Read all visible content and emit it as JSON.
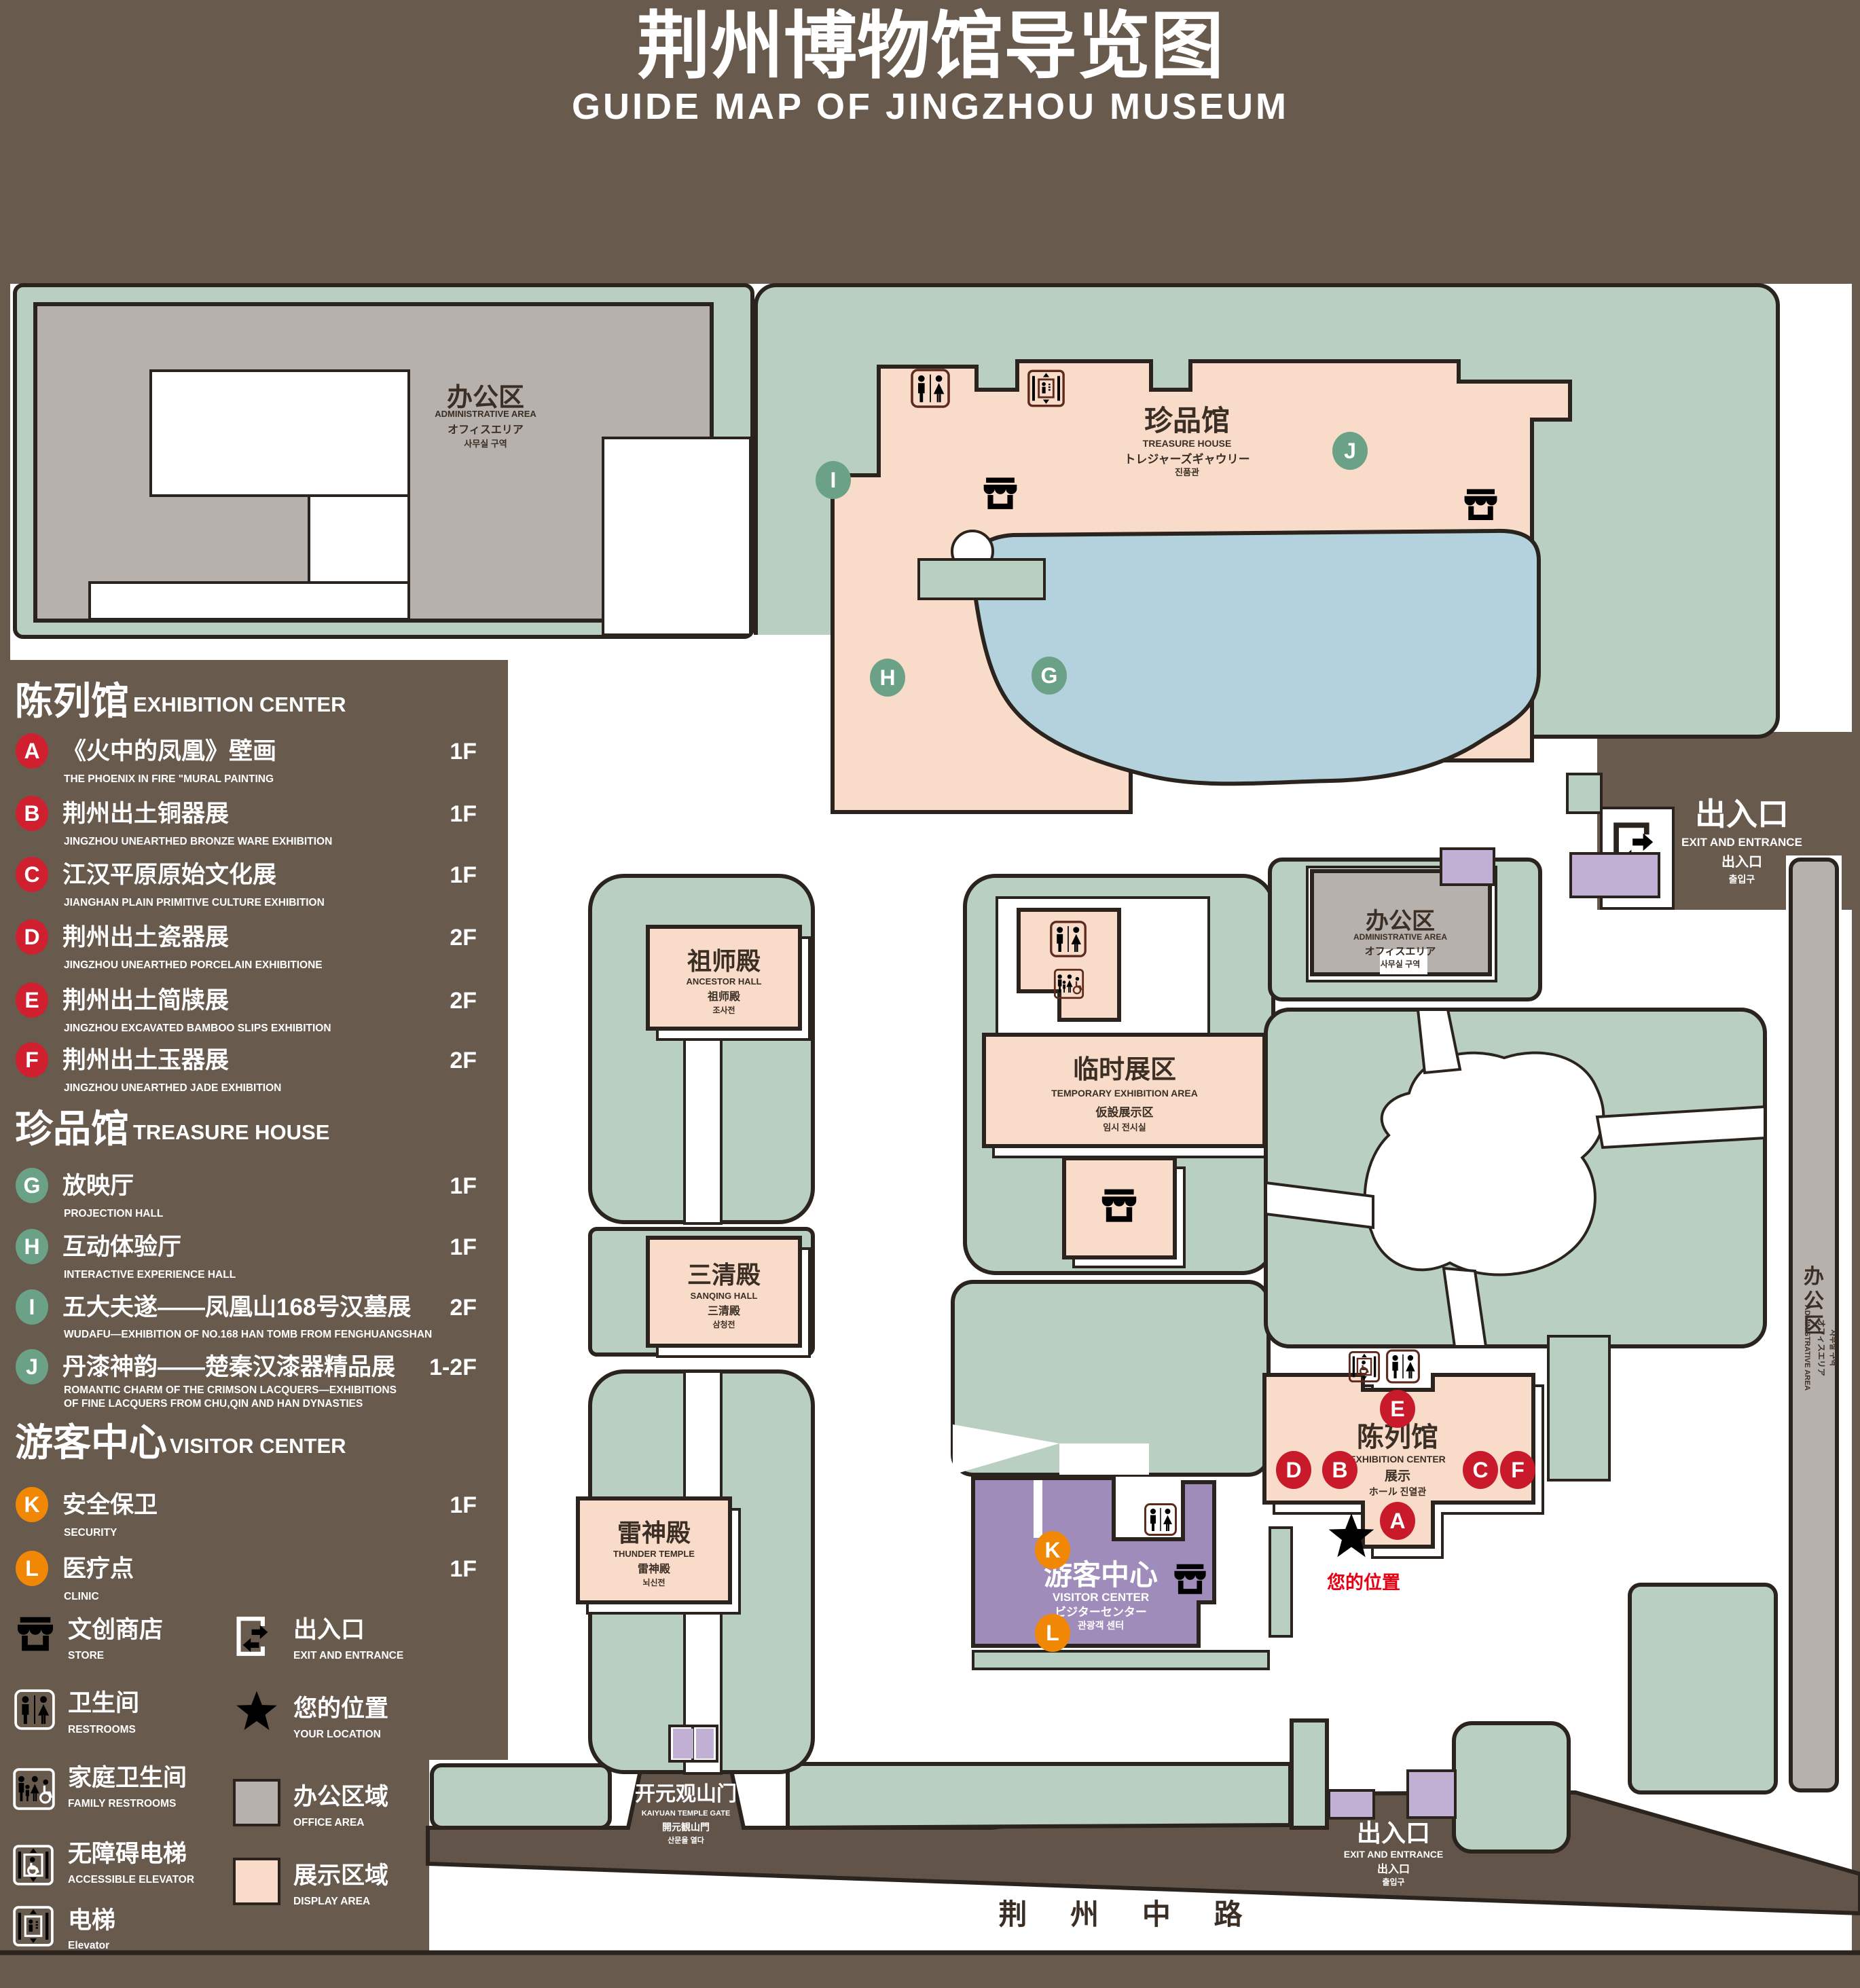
{
  "title": {
    "zh": "荆州博物馆导览图",
    "en": "GUIDE MAP OF JINGZHOU MUSEUM"
  },
  "colors": {
    "background": "#695a4e",
    "green": "#b8cfc2",
    "pink": "#f8dcc9",
    "gray": "#b6b1ac",
    "pond_blue": "#b4d2dd",
    "purple": "#9f8cba",
    "purple_light": "#c2afd4",
    "marker_red": "#c81a2b",
    "marker_green": "#6ba287",
    "marker_orange": "#f08705",
    "icon_maroon": "#5e2a1d",
    "location_red": "#e60012",
    "outline": "#2b231d"
  },
  "legend": {
    "sections": [
      {
        "zh": "陈列馆",
        "en": "EXHIBITION CENTER",
        "items": [
          {
            "id": "A",
            "zh": "《火中的凤凰》壁画",
            "en": "THE PHOENIX IN FIRE \"MURAL PAINTING",
            "floor": "1F"
          },
          {
            "id": "B",
            "zh": "荆州出土铜器展",
            "en": "JINGZHOU UNEARTHED BRONZE WARE EXHIBITION",
            "floor": "1F"
          },
          {
            "id": "C",
            "zh": "江汉平原原始文化展",
            "en": "JIANGHAN PLAIN PRIMITIVE CULTURE EXHIBITION",
            "floor": "1F"
          },
          {
            "id": "D",
            "zh": "荆州出土瓷器展",
            "en": "JINGZHOU UNEARTHED PORCELAIN EXHIBITIONE",
            "floor": "2F"
          },
          {
            "id": "E",
            "zh": "荆州出土简牍展",
            "en": "JINGZHOU EXCAVATED BAMBOO SLIPS EXHIBITION",
            "floor": "2F"
          },
          {
            "id": "F",
            "zh": "荆州出土玉器展",
            "en": "JINGZHOU UNEARTHED JADE EXHIBITION",
            "floor": "2F"
          }
        ]
      },
      {
        "zh": "珍品馆",
        "en": "TREASURE HOUSE",
        "items": [
          {
            "id": "G",
            "zh": "放映厅",
            "en": "PROJECTION HALL",
            "floor": "1F"
          },
          {
            "id": "H",
            "zh": "互动体验厅",
            "en": "INTERACTIVE EXPERIENCE HALL",
            "floor": "1F"
          },
          {
            "id": "I",
            "zh": "五大夫遂——凤凰山168号汉墓展",
            "en": "WUDAFU—EXHIBITION OF NO.168 HAN TOMB FROM FENGHUANGSHAN",
            "floor": "2F"
          },
          {
            "id": "J",
            "zh": "丹漆神韵——楚秦汉漆器精品展",
            "en": "ROMANTIC CHARM OF THE CRIMSON LACQUERS—EXHIBITIONS",
            "en2": "OF FINE LACQUERS FROM CHU,QIN AND HAN DYNASTIES",
            "floor": "1-2F"
          }
        ]
      },
      {
        "zh": "游客中心",
        "en": "VISITOR CENTER",
        "items": [
          {
            "id": "K",
            "zh": "安全保卫",
            "en": "SECURITY",
            "floor": "1F"
          },
          {
            "id": "L",
            "zh": "医疗点",
            "en": "CLINIC",
            "floor": "1F"
          }
        ]
      }
    ],
    "symbols": [
      {
        "zh": "文创商店",
        "en": "STORE"
      },
      {
        "zh": "出入口",
        "en": "EXIT AND ENTRANCE"
      },
      {
        "zh": "卫生间",
        "en": "RESTROOMS"
      },
      {
        "zh": "您的位置",
        "en": "YOUR LOCATION"
      },
      {
        "zh": "家庭卫生间",
        "en": "FAMILY RESTROOMS"
      },
      {
        "zh": "办公区域",
        "en": "OFFICE AREA"
      },
      {
        "zh": "无障碍电梯",
        "en": "ACCESSIBLE  ELEVATOR"
      },
      {
        "zh": "展示区域",
        "en": "DISPLAY AREA"
      },
      {
        "zh": "电梯",
        "en": "Elevator"
      }
    ]
  },
  "map": {
    "admin_nw": {
      "zh": "办公区",
      "en": "ADMINISTRATIVE AREA",
      "ja": "オフィスエリア",
      "ko": "사무실 구역"
    },
    "treasure": {
      "zh": "珍品馆",
      "en": "TREASURE HOUSE",
      "ja": "トレジャーズギャウリー",
      "ko": "진품관"
    },
    "ancestor": {
      "zh": "祖师殿",
      "en": "ANCESTOR HALL",
      "ja": "祖师殿",
      "ko": "조사전"
    },
    "sanqing": {
      "zh": "三清殿",
      "en": "SANQING HALL",
      "ja": "三清殿",
      "ko": "삼청전"
    },
    "thunder": {
      "zh": "雷神殿",
      "en": "THUNDER TEMPLE",
      "ja": "雷神殿",
      "ko": "뇌신전"
    },
    "temp": {
      "zh": "临时展区",
      "en": "TEMPORARY EXHIBITION AREA",
      "ja": "仮設展示区",
      "ko": "임시 전시실"
    },
    "admin_e": {
      "zh": "办公区",
      "en": "ADMINISTRATIVE AREA",
      "ja": "オフィスエリア",
      "ko": "사무실 구역"
    },
    "admin_strip": {
      "zh_chars": [
        "办",
        "公",
        "区"
      ],
      "en": "ADMINISTRATIVE AREA",
      "ja": "オフィスエリア",
      "ko": "사무실 구역"
    },
    "visitor": {
      "zh": "游客中心",
      "en": "VISITOR CENTER",
      "ja": "ビジターセンター",
      "ko": "관광객 센터"
    },
    "exhibition": {
      "zh": "陈列馆",
      "en": "EXHIBITION CENTER",
      "zh2": "展示",
      "jk": "ホール 진열관"
    },
    "exit_mid": {
      "zh": "出入口",
      "en": "EXIT AND ENTRANCE",
      "ja": "出入口",
      "ko": "출입구"
    },
    "exit_south": {
      "zh": "出入口",
      "en": "EXIT AND ENTRANCE",
      "ja": "出入口",
      "ko": "출입구"
    },
    "gate": {
      "zh": "开元观山门",
      "en": "KAIYUAN TEMPLE GATE",
      "ja": "開元観山門",
      "ko": "산문을 열다"
    },
    "road": "荆  州  中  路",
    "your_location": "您的位置",
    "markers": [
      "A",
      "B",
      "C",
      "D",
      "E",
      "F",
      "G",
      "H",
      "I",
      "J",
      "K",
      "L"
    ]
  }
}
